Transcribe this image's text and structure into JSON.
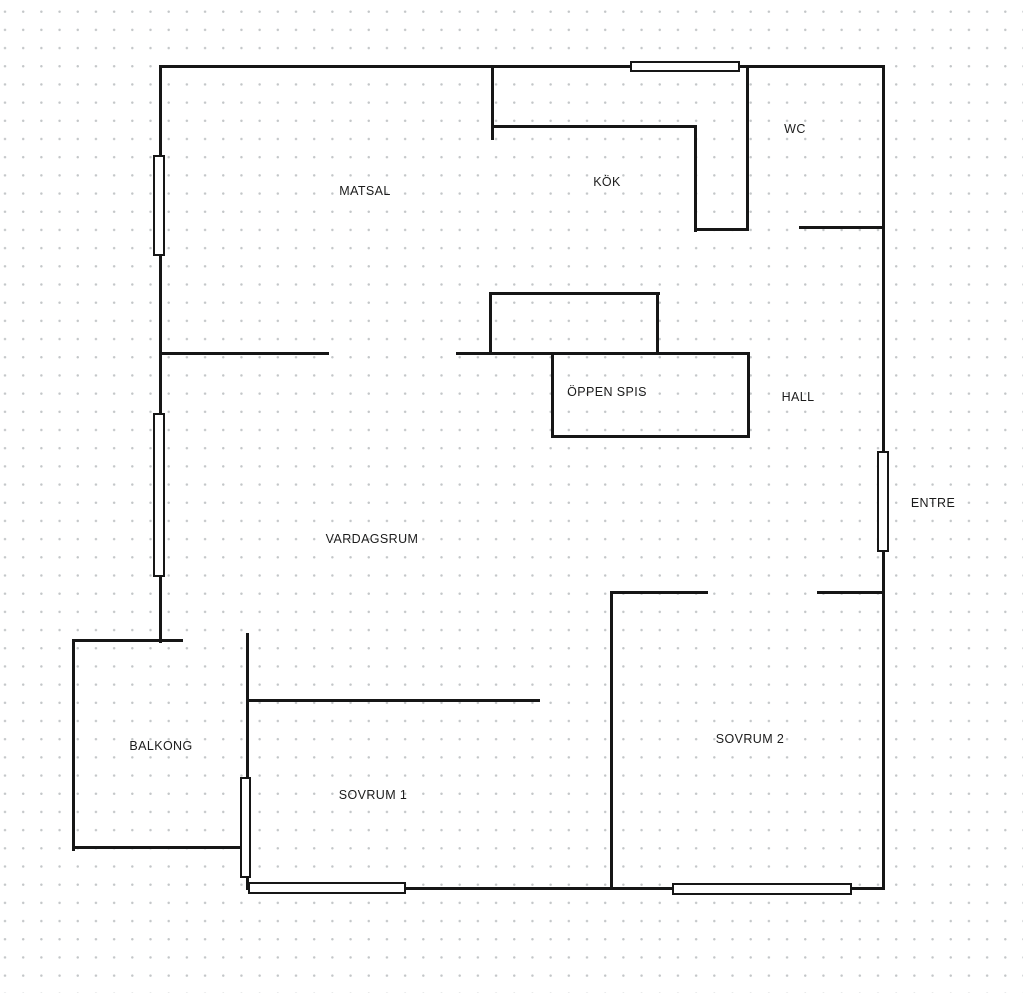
{
  "canvas": {
    "width": 1023,
    "height": 993,
    "background_color": "#ffffff",
    "dot_color": "#c3c6c8",
    "wall_color": "#161616"
  },
  "floorplan": {
    "rooms": [
      {
        "id": "matsal",
        "label": "MATSAL",
        "cx": 365,
        "cy": 191
      },
      {
        "id": "kok",
        "label": "KÖK",
        "cx": 607,
        "cy": 182
      },
      {
        "id": "wc",
        "label": "WC",
        "cx": 795,
        "cy": 129
      },
      {
        "id": "oppen-spis",
        "label": "ÖPPEN SPIS",
        "cx": 607,
        "cy": 392
      },
      {
        "id": "hall",
        "label": "HALL",
        "cx": 798,
        "cy": 397
      },
      {
        "id": "entre",
        "label": "ENTRE",
        "cx": 933,
        "cy": 503
      },
      {
        "id": "vardagsrum",
        "label": "VARDAGSRUM",
        "cx": 372,
        "cy": 539
      },
      {
        "id": "balkong",
        "label": "BALKONG",
        "cx": 161,
        "cy": 746
      },
      {
        "id": "sovrum-1",
        "label": "SOVRUM 1",
        "cx": 373,
        "cy": 795
      },
      {
        "id": "sovrum-2",
        "label": "SOVRUM 2",
        "cx": 750,
        "cy": 739
      }
    ],
    "walls": [
      {
        "id": "outer-top",
        "x": 158.5,
        "y": 65,
        "w": 726,
        "h": 3
      },
      {
        "id": "outer-right",
        "x": 881.5,
        "y": 65,
        "w": 3,
        "h": 825
      },
      {
        "id": "outer-bottom",
        "x": 245.5,
        "y": 887,
        "w": 639,
        "h": 3
      },
      {
        "id": "outer-left",
        "x": 158.5,
        "y": 65,
        "w": 3,
        "h": 578
      },
      {
        "id": "balcony-top",
        "x": 71.5,
        "y": 638.5,
        "w": 111,
        "h": 3
      },
      {
        "id": "balcony-left",
        "x": 71.5,
        "y": 638.5,
        "w": 3,
        "h": 212
      },
      {
        "id": "balcony-bottom",
        "x": 71.5,
        "y": 846,
        "w": 172,
        "h": 3
      },
      {
        "id": "sovrum1-left-upper",
        "x": 245.5,
        "y": 633,
        "w": 3,
        "h": 146
      },
      {
        "id": "sovrum1-left-lower",
        "x": 245.5,
        "y": 876,
        "w": 3,
        "h": 14
      },
      {
        "id": "kitchen-entry-stub",
        "x": 490.5,
        "y": 65,
        "w": 3,
        "h": 75
      },
      {
        "id": "kitchen-top",
        "x": 490.5,
        "y": 124.5,
        "w": 206,
        "h": 3
      },
      {
        "id": "kitchen-inner-right",
        "x": 693.5,
        "y": 124.5,
        "w": 3,
        "h": 107
      },
      {
        "id": "kitchen-bottom",
        "x": 693.5,
        "y": 228,
        "w": 55,
        "h": 3
      },
      {
        "id": "kitchen-wc-divider",
        "x": 745.5,
        "y": 65,
        "w": 3,
        "h": 166
      },
      {
        "id": "wc-bottom",
        "x": 799,
        "y": 225.5,
        "w": 85.5,
        "h": 3
      },
      {
        "id": "matsal-south",
        "x": 158.5,
        "y": 351.5,
        "w": 170,
        "h": 3
      },
      {
        "id": "fireplace-wall",
        "x": 455.5,
        "y": 351.5,
        "w": 294,
        "h": 3
      },
      {
        "id": "fireplace-upper-top",
        "x": 488.5,
        "y": 291.5,
        "w": 171,
        "h": 3
      },
      {
        "id": "fireplace-upper-left",
        "x": 488.5,
        "y": 291.5,
        "w": 3,
        "h": 62
      },
      {
        "id": "fireplace-upper-right",
        "x": 656,
        "y": 291.5,
        "w": 3,
        "h": 62
      },
      {
        "id": "fireplace-lower-left",
        "x": 550.5,
        "y": 353,
        "w": 3,
        "h": 85
      },
      {
        "id": "fireplace-lower-bottom",
        "x": 550.5,
        "y": 435,
        "w": 199,
        "h": 3
      },
      {
        "id": "fireplace-lower-right",
        "x": 746.5,
        "y": 353,
        "w": 3,
        "h": 85
      },
      {
        "id": "sovrum1-top",
        "x": 245.5,
        "y": 698.5,
        "w": 294,
        "h": 3
      },
      {
        "id": "sovrum-divider",
        "x": 609.5,
        "y": 590.5,
        "w": 3,
        "h": 299
      },
      {
        "id": "sovrum2-top-left",
        "x": 609.5,
        "y": 590.5,
        "w": 98,
        "h": 3
      },
      {
        "id": "sovrum2-top-right",
        "x": 816.5,
        "y": 590.5,
        "w": 68,
        "h": 3
      }
    ],
    "windows": [
      {
        "id": "window-top-kok",
        "x": 630,
        "y": 61,
        "w": 110,
        "h": 11
      },
      {
        "id": "window-left-matsal",
        "x": 153,
        "y": 155,
        "w": 12,
        "h": 101
      },
      {
        "id": "window-left-vardagsrum",
        "x": 153,
        "y": 413,
        "w": 12,
        "h": 164
      },
      {
        "id": "window-entre-door",
        "x": 877,
        "y": 451,
        "w": 12,
        "h": 101
      },
      {
        "id": "window-balcony-door",
        "x": 240,
        "y": 777,
        "w": 11,
        "h": 101
      },
      {
        "id": "window-bottom-sovrum1",
        "x": 248,
        "y": 882,
        "w": 158,
        "h": 12
      },
      {
        "id": "window-bottom-sovrum2",
        "x": 672,
        "y": 883,
        "w": 180,
        "h": 12
      }
    ]
  }
}
